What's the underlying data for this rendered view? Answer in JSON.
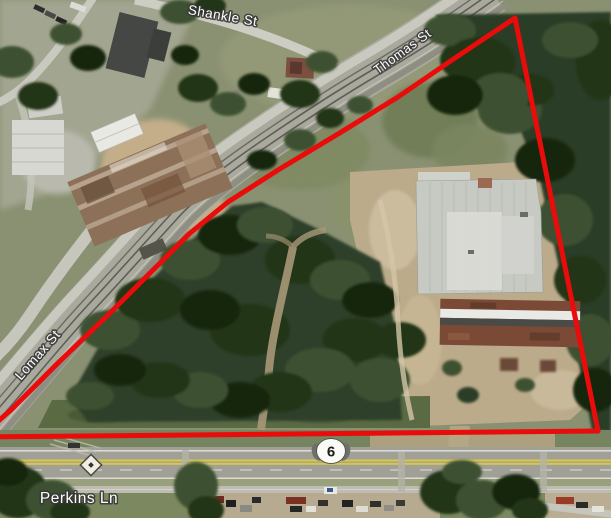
{
  "map": {
    "kind": "aerial-satellite-parcel-view",
    "street_labels": [
      {
        "id": "shankle-st",
        "text": "Shankle St"
      },
      {
        "id": "thomas-st",
        "text": "Thomas St"
      },
      {
        "id": "lomax-st",
        "text": "Lomax St"
      },
      {
        "id": "perkins-ln",
        "text": "Perkins Ln"
      }
    ],
    "route_marker": {
      "type": "state-route-oval",
      "number": "6"
    },
    "parcel_boundary": {
      "color": "#ea0b0b",
      "stroke_width_px": 5
    },
    "markers": {
      "railroad_crossing_sign": "white-diamond-black-dot"
    },
    "palette": {
      "tree_dark": "#243618",
      "tree_mid": "#3d5130",
      "grass_olive": "#879168",
      "dirt_tan": "#bcab8b",
      "road_gray": "#b3b3a8",
      "highway_gray": "#a0a096",
      "lane_yellow": "#d9c748",
      "roof_light": "#c9cbc5",
      "roof_rust": "#8d7058",
      "roof_brown": "#7a4a36",
      "label_color": "#ffffff"
    }
  }
}
